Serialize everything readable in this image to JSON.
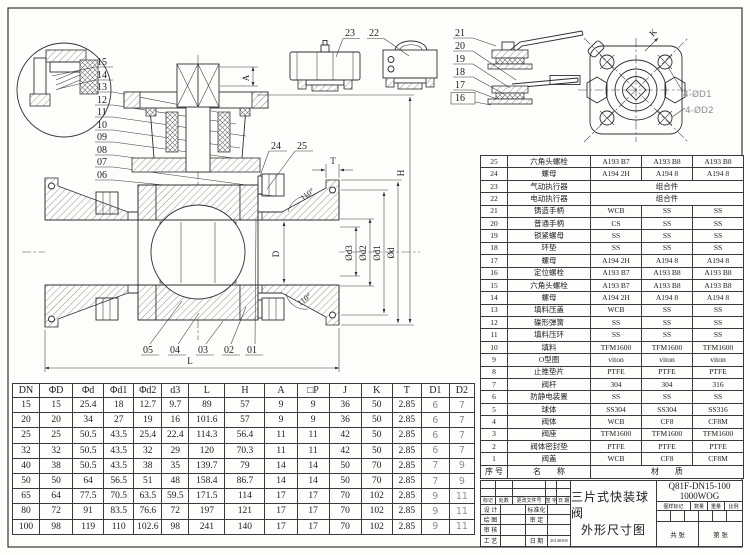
{
  "colors": {
    "line": "#2e2e2e",
    "gray_annotation": "#8f8f8f"
  },
  "drawing": {
    "callouts_left": [
      "15",
      "14",
      "13",
      "12",
      "11",
      "10",
      "09",
      "08",
      "07",
      "06"
    ],
    "callouts_body": [
      "24",
      "25"
    ],
    "callouts_actuator": [
      "23",
      "22"
    ],
    "callouts_handle": [
      "21",
      "20",
      "19",
      "18",
      "17",
      "16"
    ],
    "callouts_bottom": [
      "05",
      "04",
      "03",
      "02",
      "01"
    ],
    "dim_A": "A",
    "dim_H": "H",
    "dim_T": "T",
    "dim_L": "L",
    "dim_D": "D",
    "dim_K": "K",
    "dim_phi_d3": "Ød3",
    "dim_phi_d2": "Ød2",
    "dim_phi_d1": "Ød1",
    "dim_phi_d": "Ød",
    "angle_top": "110°",
    "angle_bottom": "110°",
    "holes_label_1": "4-ØD1",
    "holes_label_2": "4-ØD2"
  },
  "parts_table": {
    "footer": {
      "no": "序 号",
      "name": "名        称",
      "material": "材        质"
    },
    "rows": [
      {
        "no": "25",
        "name": "六角头螺栓",
        "m1": "A193 B7",
        "m2": "A193 B8",
        "m3": "A193 B8"
      },
      {
        "no": "24",
        "name": "螺母",
        "m1": "A194 2H",
        "m2": "A194 8",
        "m3": "A194 8"
      },
      {
        "no": "23",
        "name": "气动执行器",
        "span": "组合件"
      },
      {
        "no": "22",
        "name": "电动执行器",
        "span": "组合件"
      },
      {
        "no": "21",
        "name": "铸造手柄",
        "m1": "WCB",
        "m2": "SS",
        "m3": "SS"
      },
      {
        "no": "20",
        "name": "普通手柄",
        "m1": "CS",
        "m2": "SS",
        "m3": "SS"
      },
      {
        "no": "19",
        "name": "锁紧螺母",
        "m1": "SS",
        "m2": "SS",
        "m3": "SS"
      },
      {
        "no": "18",
        "name": "环垫",
        "m1": "SS",
        "m2": "SS",
        "m3": "SS"
      },
      {
        "no": "17",
        "name": "螺母",
        "m1": "A194 2H",
        "m2": "A194 8",
        "m3": "A194 8"
      },
      {
        "no": "16",
        "name": "定位螺栓",
        "m1": "A193 B7",
        "m2": "A193 B8",
        "m3": "A193 B8"
      },
      {
        "no": "15",
        "name": "六角头螺栓",
        "m1": "A193 B7",
        "m2": "A193 B8",
        "m3": "A193 B8"
      },
      {
        "no": "14",
        "name": "螺母",
        "m1": "A194 2H",
        "m2": "A194 8",
        "m3": "A194 8"
      },
      {
        "no": "13",
        "name": "填料压盖",
        "m1": "WCB",
        "m2": "SS",
        "m3": "SS"
      },
      {
        "no": "12",
        "name": "碟形弹簧",
        "m1": "SS",
        "m2": "SS",
        "m3": "SS"
      },
      {
        "no": "11",
        "name": "填料压环",
        "m1": "SS",
        "m2": "SS",
        "m3": "SS"
      },
      {
        "no": "10",
        "name": "填料",
        "m1": "TFM1600",
        "m2": "TFM1600",
        "m3": "TFM1600"
      },
      {
        "no": "9",
        "name": "O型圈",
        "m1": "viton",
        "m2": "viton",
        "m3": "viton"
      },
      {
        "no": "8",
        "name": "止推垫片",
        "m1": "PTFE",
        "m2": "PTFE",
        "m3": "PTFE"
      },
      {
        "no": "7",
        "name": "阀杆",
        "m1": "304",
        "m2": "304",
        "m3": "316"
      },
      {
        "no": "6",
        "name": "防静电装置",
        "m1": "SS",
        "m2": "SS",
        "m3": "SS"
      },
      {
        "no": "5",
        "name": "球体",
        "m1": "SS304",
        "m2": "SS304",
        "m3": "SS316"
      },
      {
        "no": "4",
        "name": "阀体",
        "m1": "WCB",
        "m2": "CF8",
        "m3": "CF8M"
      },
      {
        "no": "3",
        "name": "阀座",
        "m1": "TFM1600",
        "m2": "TFM1600",
        "m3": "TFM1600"
      },
      {
        "no": "2",
        "name": "阀体密封垫",
        "m1": "PTFE",
        "m2": "PTFE",
        "m3": "PTFE"
      },
      {
        "no": "1",
        "name": "阀盖",
        "m1": "WCB",
        "m2": "CF8",
        "m3": "CF8M"
      }
    ]
  },
  "dims_table": {
    "headers": [
      "DN",
      "ΦD",
      "Φd",
      "Φd1",
      "Φd2",
      "d3",
      "L",
      "H",
      "A",
      "□P",
      "J",
      "K",
      "T",
      "D1",
      "D2"
    ],
    "rows": [
      [
        "15",
        "15",
        "25.4",
        "18",
        "12.7",
        "9.7",
        "89",
        "57",
        "9",
        "9",
        "36",
        "50",
        "2.85",
        "6",
        "7"
      ],
      [
        "20",
        "20",
        "34",
        "27",
        "19",
        "16",
        "101.6",
        "57",
        "9",
        "9",
        "36",
        "50",
        "2.85",
        "6",
        "7"
      ],
      [
        "25",
        "25",
        "50.5",
        "43.5",
        "25.4",
        "22.4",
        "114.3",
        "56.4",
        "11",
        "11",
        "42",
        "50",
        "2.85",
        "6",
        "7"
      ],
      [
        "32",
        "32",
        "50.5",
        "43.5",
        "32",
        "29",
        "120",
        "70.3",
        "11",
        "11",
        "42",
        "50",
        "2.85",
        "6",
        "7"
      ],
      [
        "40",
        "38",
        "50.5",
        "43.5",
        "38",
        "35",
        "139.7",
        "79",
        "14",
        "14",
        "50",
        "70",
        "2.85",
        "7",
        "9"
      ],
      [
        "50",
        "50",
        "64",
        "56.5",
        "51",
        "48",
        "158.4",
        "86.7",
        "14",
        "14",
        "50",
        "70",
        "2.85",
        "7",
        "9"
      ],
      [
        "65",
        "64",
        "77.5",
        "70.5",
        "63.5",
        "59.5",
        "171.5",
        "114",
        "17",
        "17",
        "70",
        "102",
        "2.85",
        "9",
        "11"
      ],
      [
        "80",
        "72",
        "91",
        "83.5",
        "76.6",
        "72",
        "197",
        "121",
        "17",
        "17",
        "70",
        "102",
        "2.85",
        "9",
        "11"
      ],
      [
        "100",
        "98",
        "119",
        "110",
        "102.6",
        "98",
        "241",
        "140",
        "17",
        "17",
        "70",
        "102",
        "2.85",
        "9",
        "11"
      ]
    ]
  },
  "title_block": {
    "rev_header": [
      "标记",
      "处数",
      "更改文件号",
      "签 字",
      "日 期"
    ],
    "sign_rows": [
      {
        "l": "设 计",
        "r": "标准化",
        "rv": ""
      },
      {
        "l": "绘 图",
        "r": "审 定",
        "rv": ""
      },
      {
        "l": "审 核",
        "r": "",
        "rv": ""
      },
      {
        "l": "工 艺",
        "r": "日 期",
        "rv": "20140305"
      }
    ],
    "title_line1": "三片式快装球阀",
    "title_line2": "外形尺寸图",
    "model": "Q81F-DN15-100",
    "rating": "1000WOG",
    "info_headers": [
      "图样标记",
      "数量",
      "重量",
      "比例"
    ],
    "sheet_left": "共    张",
    "sheet_right": "第    张"
  }
}
